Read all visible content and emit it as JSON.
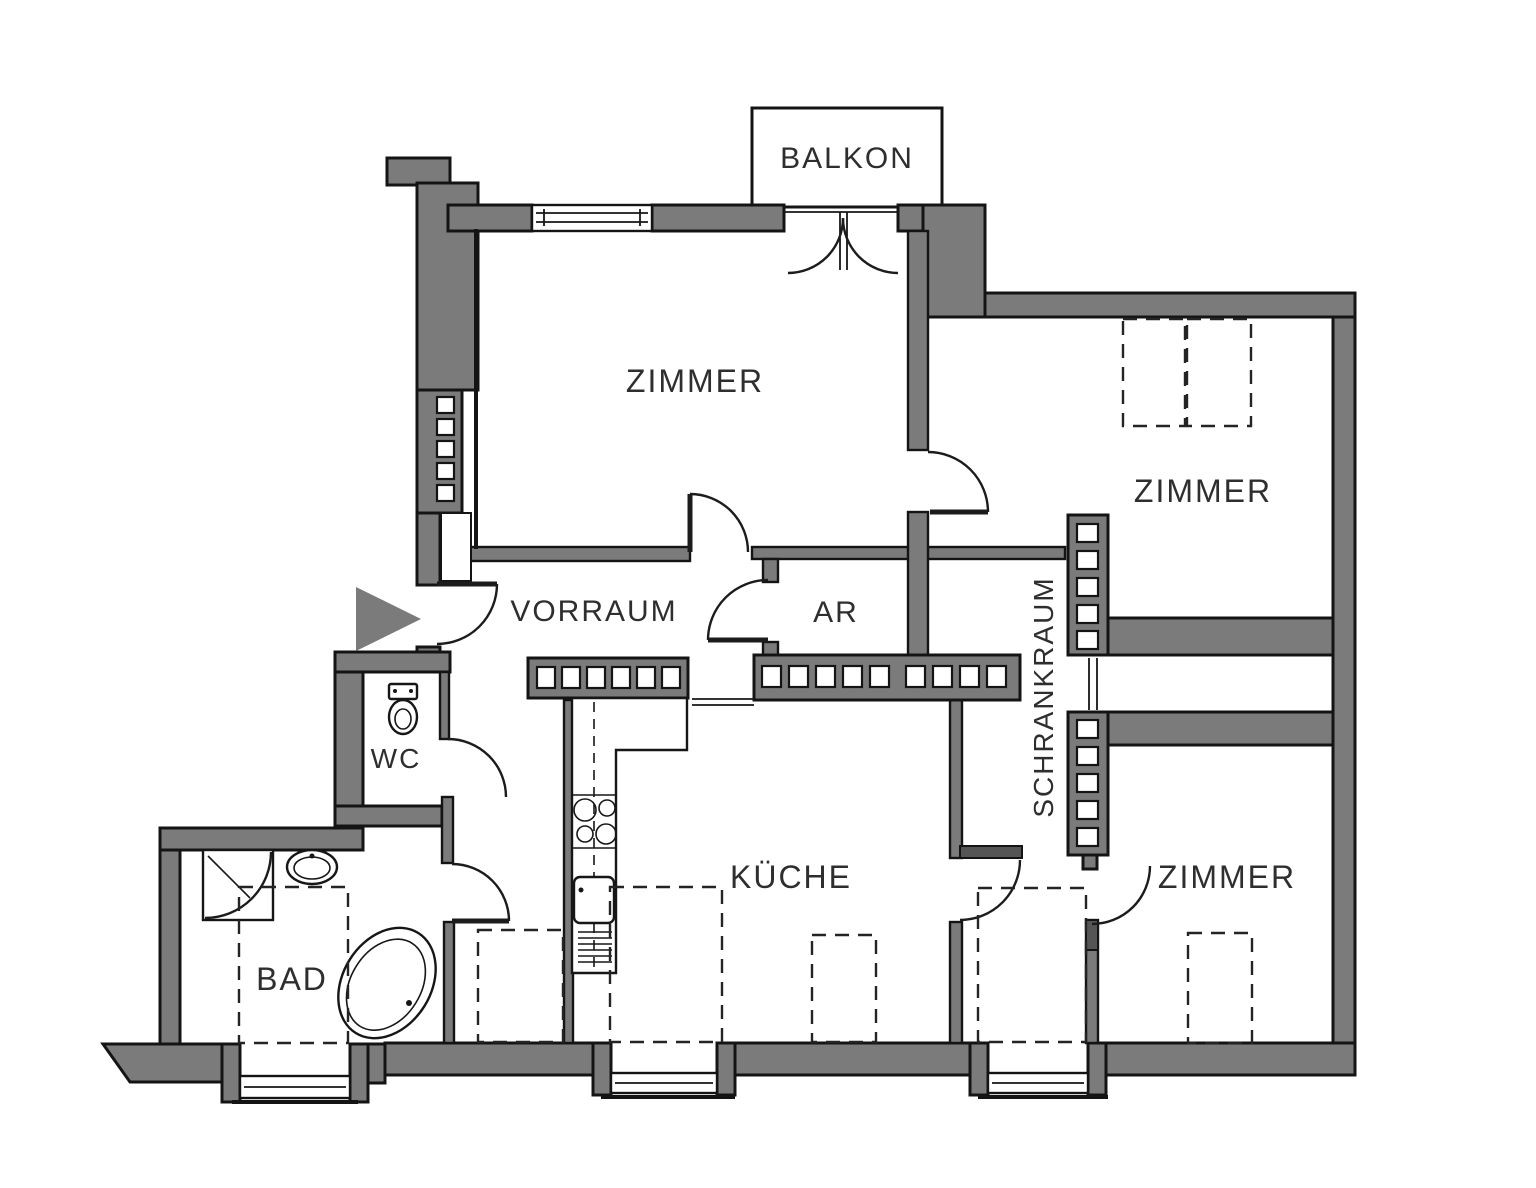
{
  "plan": {
    "type": "apartment-floor-plan",
    "labels": {
      "balkon": "BALKON",
      "zimmer_top_left": "ZIMMER",
      "zimmer_top_right": "ZIMMER",
      "zimmer_bottom_right": "ZIMMER",
      "vorraum": "VORRAUM",
      "ar": "AR",
      "schrankraum": "SCHRANKRAUM",
      "wc": "WC",
      "kueche": "KÜCHE",
      "bad": "BAD"
    },
    "colors": {
      "wall": "#7b7b7b",
      "outline": "#141414",
      "label": "#2e2e2e",
      "background": "#ffffff"
    }
  }
}
